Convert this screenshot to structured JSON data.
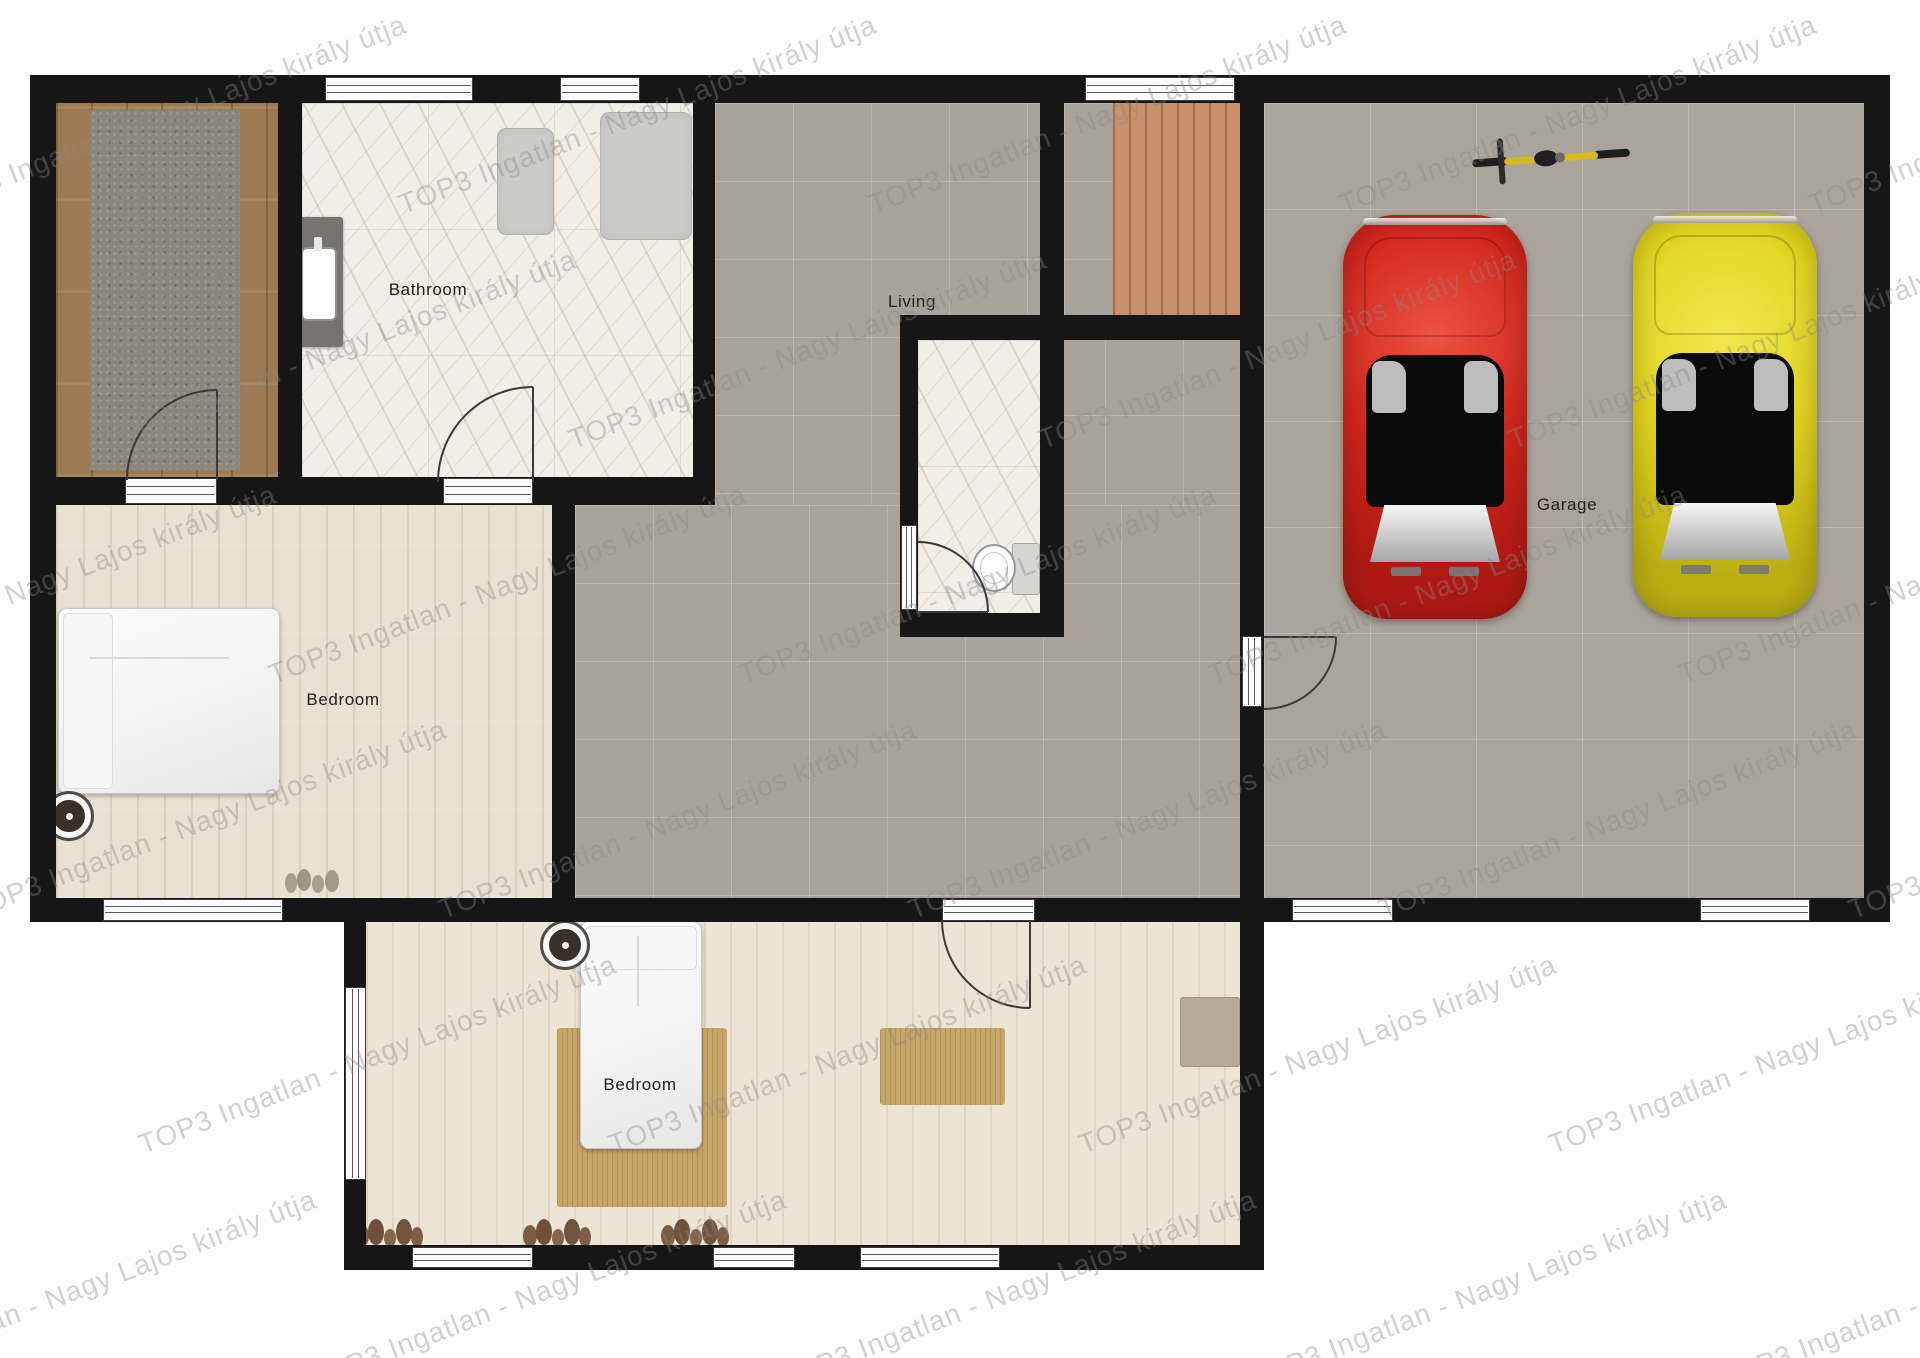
{
  "watermark": {
    "text": "TOP3 Ingatlan - Nagy Lajos király útja"
  },
  "labels": {
    "bathroom": "Bathroom",
    "living": "Living",
    "garage": "Garage",
    "bedroom_left": "Bedroom",
    "bedroom_bottom": "Bedroom"
  },
  "colors": {
    "wall": "#161616",
    "tile_gray": "#a8a29a",
    "bedroom_floor": "#e9e1d1",
    "hall_wood": "#9c7b53",
    "marble": "#f1eee8",
    "deck_wood": "#c8906b",
    "rug_tan": "#c7a66a",
    "car_red": "#d2261c",
    "car_yellow": "#e0d31d",
    "bike_yellow": "#d9b91c",
    "watermark_gray": "#8a8a8a"
  }
}
